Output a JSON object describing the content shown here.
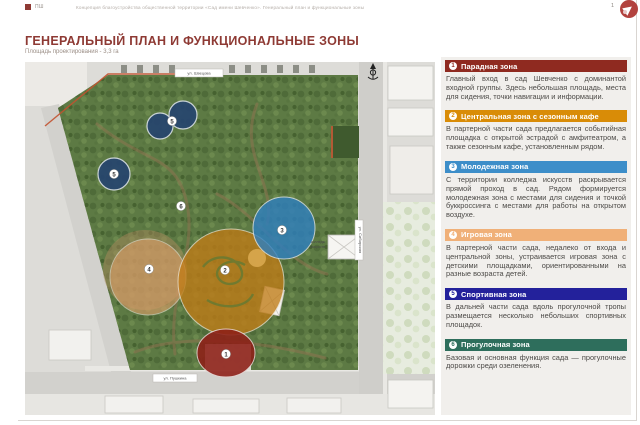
{
  "page": {
    "brand_mark": "ПШ",
    "doc_header_line": "Концепция благоустройства общественной территории «Сад имени Шевченко». Генеральный план и функциональные зоны",
    "page_number": "1",
    "title": "ГЕНЕРАЛЬНЫЙ ПЛАН И ФУНКЦИОНАЛЬНЫЕ ЗОНЫ",
    "subtitle": "Площадь проектирования - 3,3 га"
  },
  "map": {
    "street_labels": {
      "top": "ул. Швецова",
      "right": "ул. Сибирская",
      "bottom": "ул. Пушкина"
    },
    "building_label_line1": "колледж",
    "building_label_line2": "искусств",
    "circle_colors": {
      "paradnaya": "#8e1f17",
      "centralnaya": "#c07c17",
      "molodezhnaya": "#2e7fc0",
      "igrovaya": "#e0a06a",
      "sportivnaya": "#26456f"
    },
    "markers": [
      {
        "num": "1"
      },
      {
        "num": "2"
      },
      {
        "num": "3"
      },
      {
        "num": "4"
      },
      {
        "num": "5"
      },
      {
        "num": "5"
      },
      {
        "num": "6"
      }
    ]
  },
  "legend": {
    "zones": [
      {
        "num": "1",
        "name": "Парадная зона",
        "color": "#8f2a20",
        "text": "Главный вход в сад Шевченко с доминантой входной группы. Здесь небольшая площадь, места для сидения, точки навигации и информации."
      },
      {
        "num": "2",
        "name": "Центральная зона с сезонным кафе",
        "color": "#d98c07",
        "text": "В партерной части сада предлагается событийная площадка с открытой эстрадой с амфитеатром, а также сезонным кафе, установленным рядом."
      },
      {
        "num": "3",
        "name": "Молодежная зона",
        "color": "#3d8ec9",
        "text": "С территории колледжа искусств раскрывается прямой проход в сад. Рядом формируется молодежная зона с местами для сидения и точкой буккроссинга с местами для работы на открытом воздухе."
      },
      {
        "num": "4",
        "name": "Игровая зона",
        "color": "#f0b078",
        "text": "В партерной части сада, недалеко от входа и центральной зоны, устраивается игровая зона с детскими площадками, ориентированными на разные возраста детей."
      },
      {
        "num": "5",
        "name": "Спортивная зона",
        "color": "#23219b",
        "text": "В дальней части сада вдоль прогулочной тропы размещается несколько небольших спортивных площадок."
      },
      {
        "num": "6",
        "name": "Прогулочная зона",
        "color": "#2e6e5c",
        "text": "Базовая и основная функция сада — прогулочные дорожки среди озеленения."
      }
    ]
  }
}
